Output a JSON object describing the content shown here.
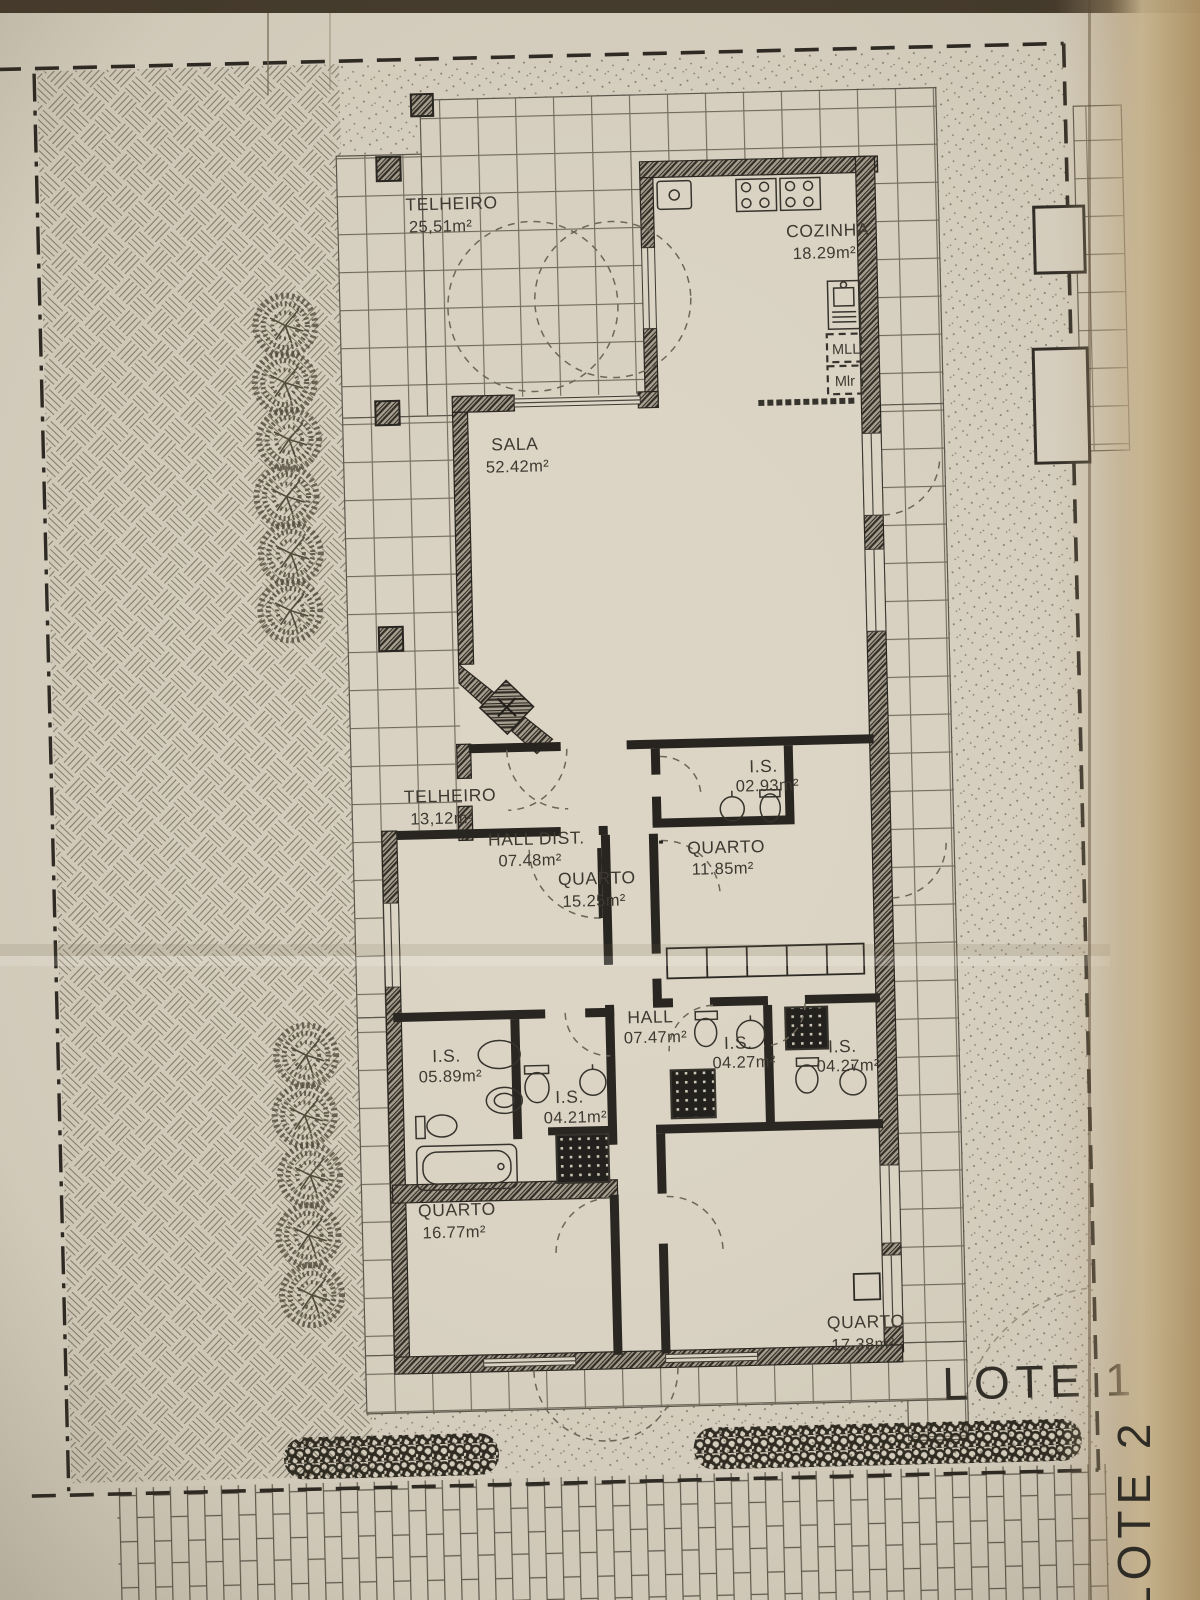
{
  "labels": {
    "lote1": "LOTE 1",
    "lote2": "LOTE 2",
    "mll": "MLL",
    "mlr": "Mlr"
  },
  "rooms": [
    {
      "name": "TELHEIRO",
      "area": "25,51m²"
    },
    {
      "name": "COZINHA",
      "area": "18.29m²"
    },
    {
      "name": "SALA",
      "area": "52.42m²"
    },
    {
      "name": "TELHEIRO",
      "area": "13,12m²"
    },
    {
      "name": "HALL DIST.",
      "area": "07.48m²"
    },
    {
      "name": "I.S.",
      "area": "02.93m²"
    },
    {
      "name": "QUARTO",
      "area": "15.25m²"
    },
    {
      "name": "QUARTO",
      "area": "11.85m²"
    },
    {
      "name": "HALL",
      "area": "07.47m²"
    },
    {
      "name": "I.S.",
      "area": "05.89m²"
    },
    {
      "name": "I.S.",
      "area": "04.21m²"
    },
    {
      "name": "I.S.",
      "area": "04.27m²"
    },
    {
      "name": "I.S.",
      "area": "04.27m²"
    },
    {
      "name": "QUARTO",
      "area": "16.77m²"
    },
    {
      "name": "QUARTO",
      "area": "17.38m²"
    }
  ],
  "colors": {
    "paper": "#d8d1c1",
    "fold": "#c3ab82",
    "ink": "#3b372f",
    "wall": "#26231e"
  }
}
